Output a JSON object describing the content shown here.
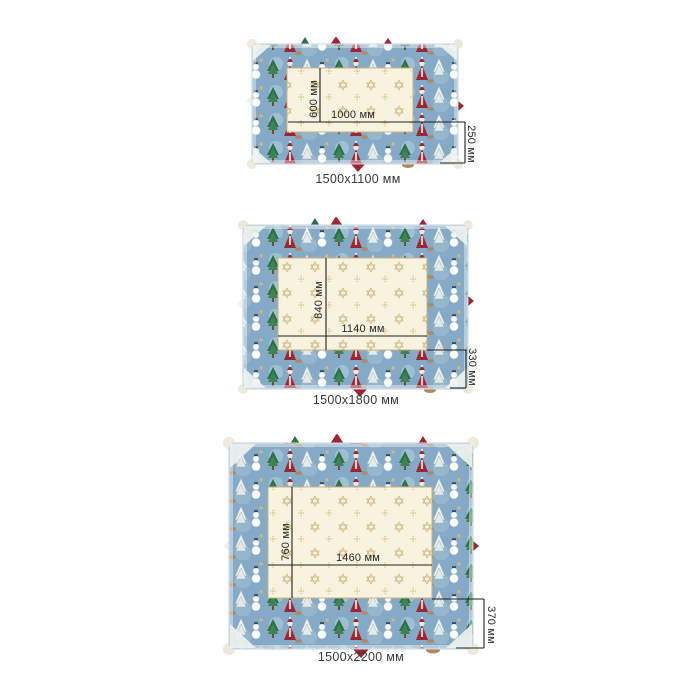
{
  "products": [
    {
      "size_caption": "1500х1100 мм",
      "inner_width": "1000 мм",
      "inner_height": "600 мм",
      "border_width": "250 мм"
    },
    {
      "size_caption": "1500х1800 мм",
      "inner_width": "1140 мм",
      "inner_height": "840 мм",
      "border_width": "330 мм"
    },
    {
      "size_caption": "1500х2200 мм",
      "inner_width": "1460 мм",
      "inner_height": "760 мм",
      "border_width": "370 мм"
    }
  ],
  "design": {
    "center_motif": "gold six-point stars on cream",
    "border_motifs": [
      "santa",
      "christmas-tree",
      "snowy-tree",
      "snowman",
      "deer",
      "bell"
    ]
  },
  "colors": {
    "background": "#ffffff",
    "cloth_center": "#f8f3df",
    "center_star_gold": "#d3bd88",
    "border_blue": "#84aac7",
    "border_blue_light": "#a6c4d8",
    "santa_red": "#9e2531",
    "tree_green": "#2f7044",
    "snow_white": "#f2f4f1",
    "deer_tan": "#b3895a",
    "gold_trim": "#c9b47e",
    "dimension_line": "#1f1f1f",
    "caption_text": "#3a3a3a"
  }
}
